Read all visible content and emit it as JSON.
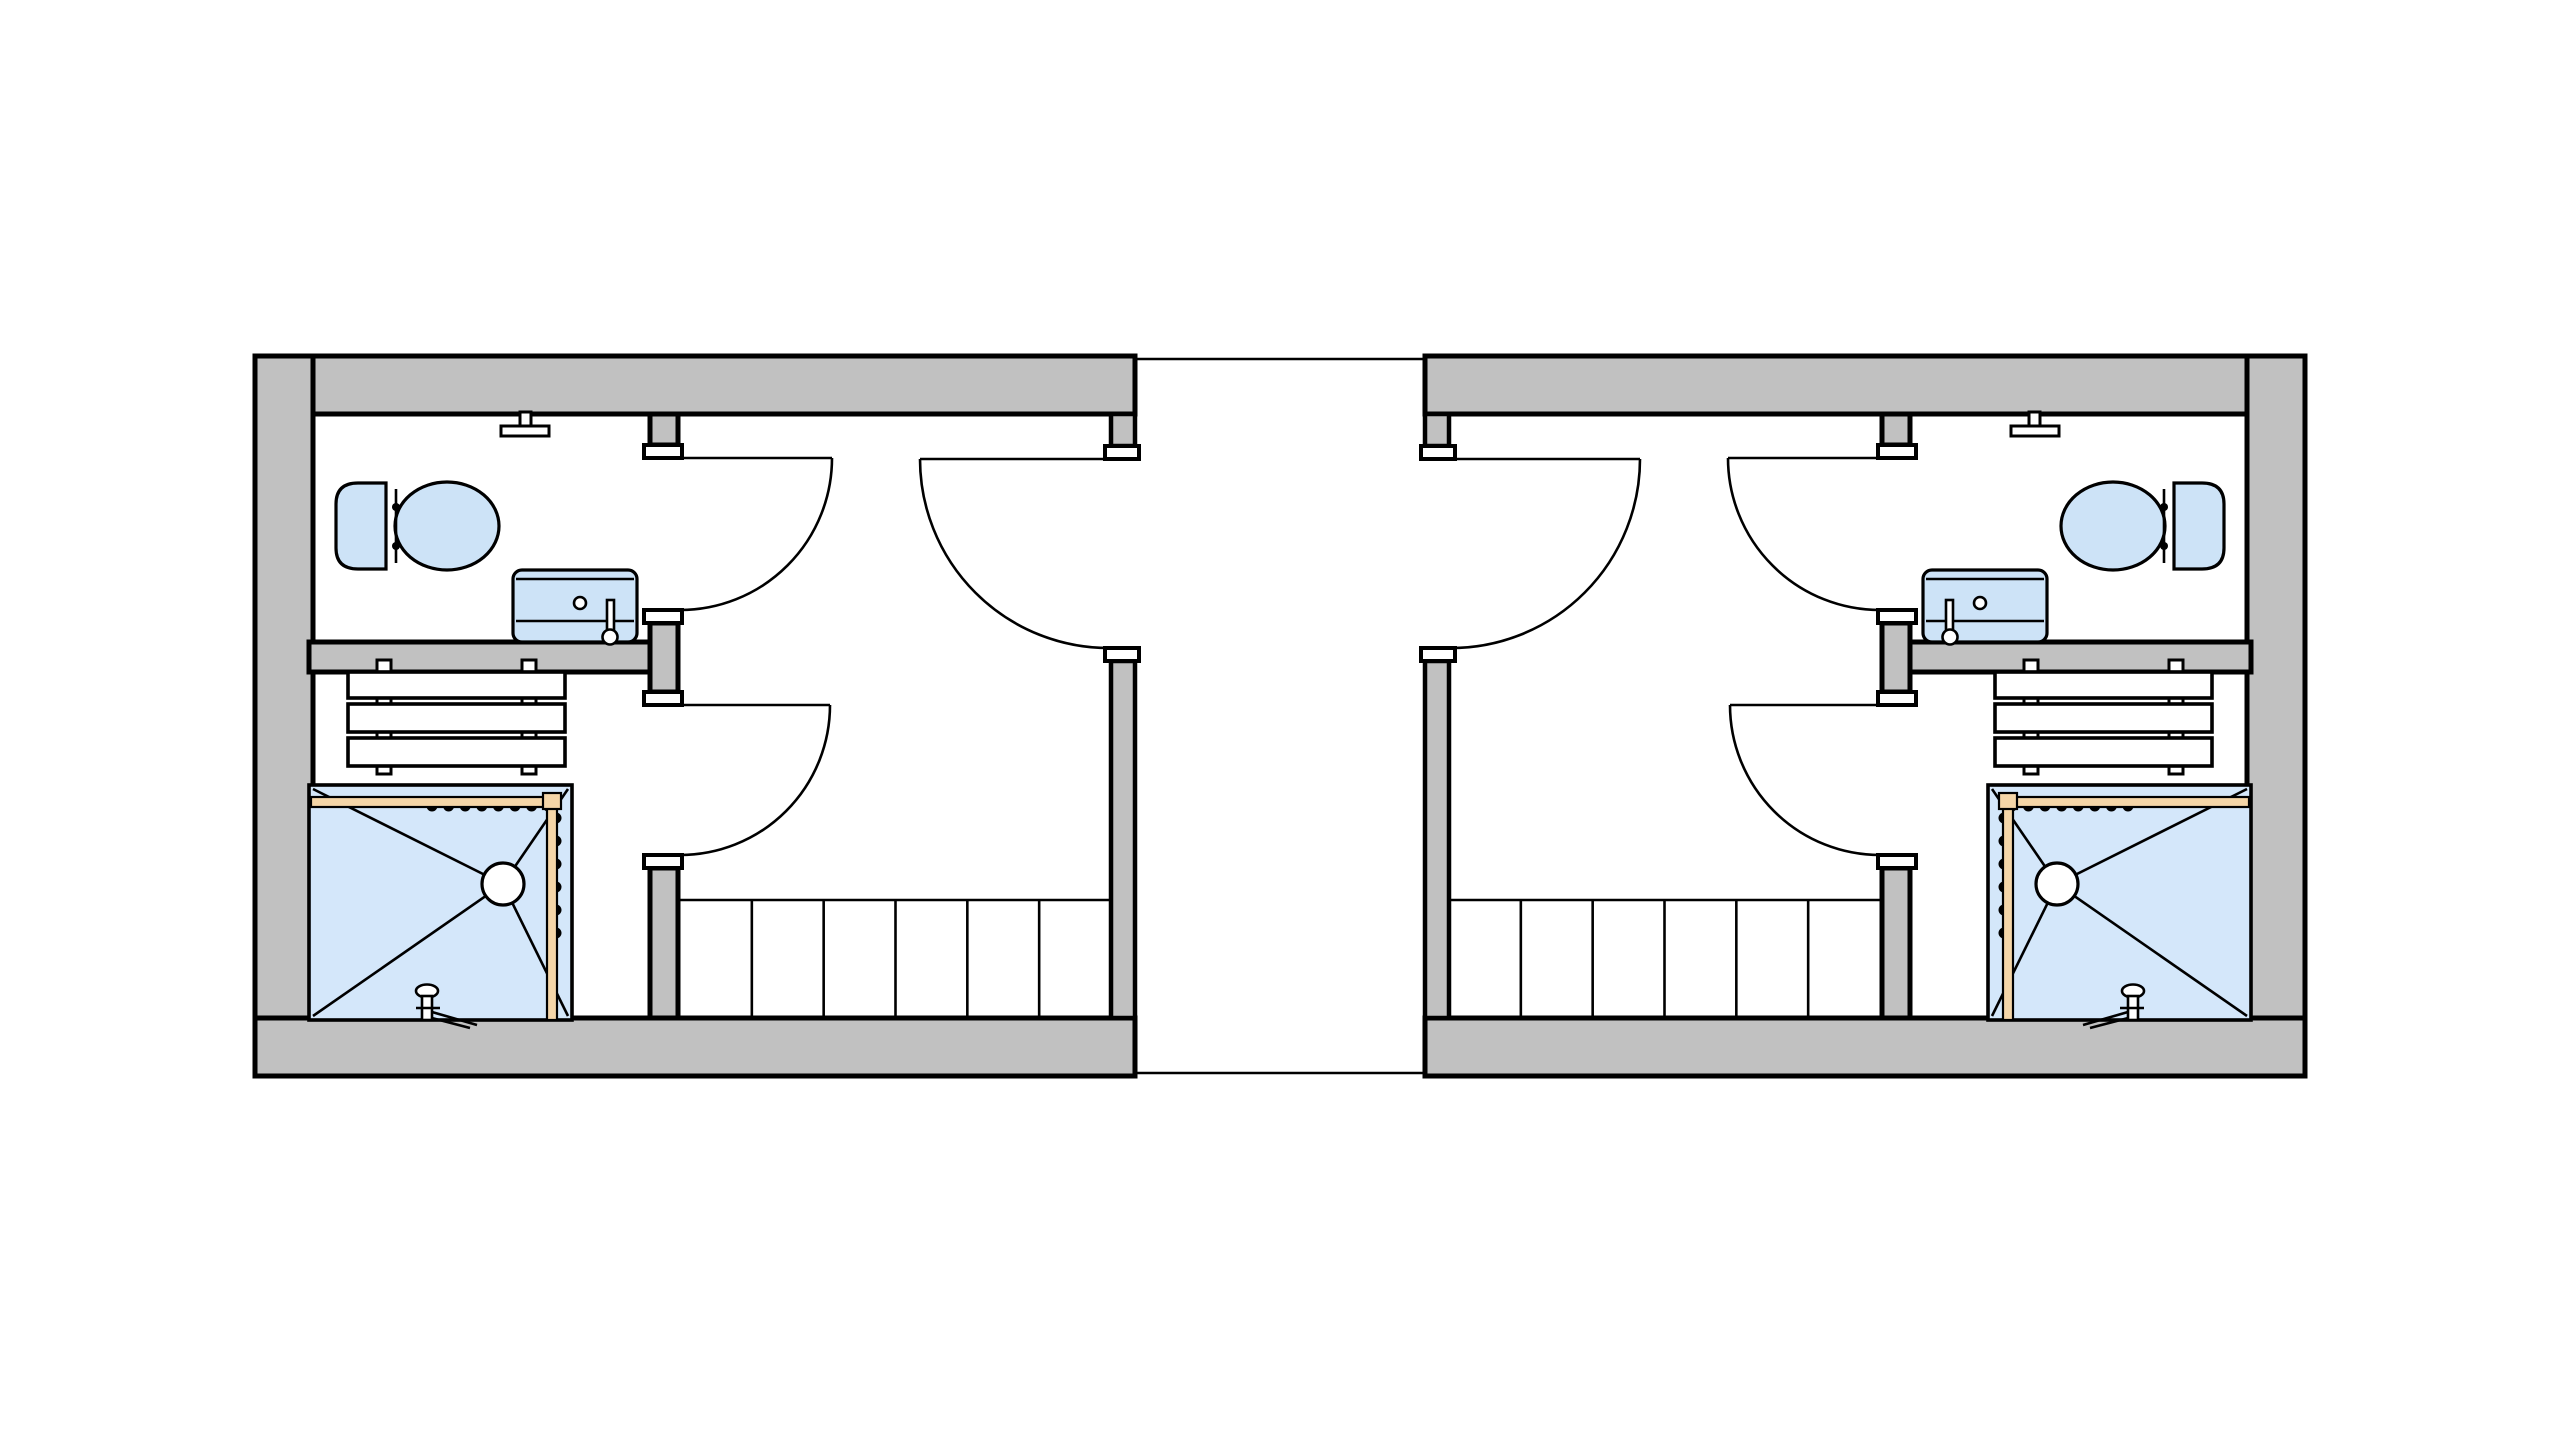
{
  "palette": {
    "background": "#ffffff",
    "wall_fill": "#c1c1c1",
    "outline": "#000000",
    "fixture_fill": "#cde3f7",
    "shower_fill": "#d4e7fa",
    "rail_fill": "#f5d6a8",
    "jamb_fill": "#ffffff",
    "board_fill": "#ffffff"
  },
  "plan": {
    "units": [
      {
        "id": "unit-left",
        "side": "left",
        "mirrored": false
      },
      {
        "id": "unit-right",
        "side": "right",
        "mirrored": true
      }
    ],
    "corridor": {
      "has_top_edge_line": true,
      "has_bottom_edge_line": true
    },
    "unit_template": {
      "rooms": [
        "bathroom",
        "storage-room",
        "shower-area",
        "stair-hall",
        "entry-hall"
      ],
      "doors": [
        "bathroom-door",
        "storage-door",
        "entry-door"
      ],
      "fixtures": [
        "toilet",
        "sink",
        "wall-tap",
        "bench-shelving",
        "shower-pan",
        "shower-drain",
        "curtain-rail",
        "shower-mixer",
        "staircase"
      ],
      "staircase": {
        "tread_count": 6
      },
      "bench_shelving": {
        "board_count": 3,
        "post_count": 2
      },
      "curtain_rail": {
        "top_hook_count": 8,
        "side_hook_count": 6
      },
      "shower": {
        "diagonal_count": 4
      }
    }
  }
}
